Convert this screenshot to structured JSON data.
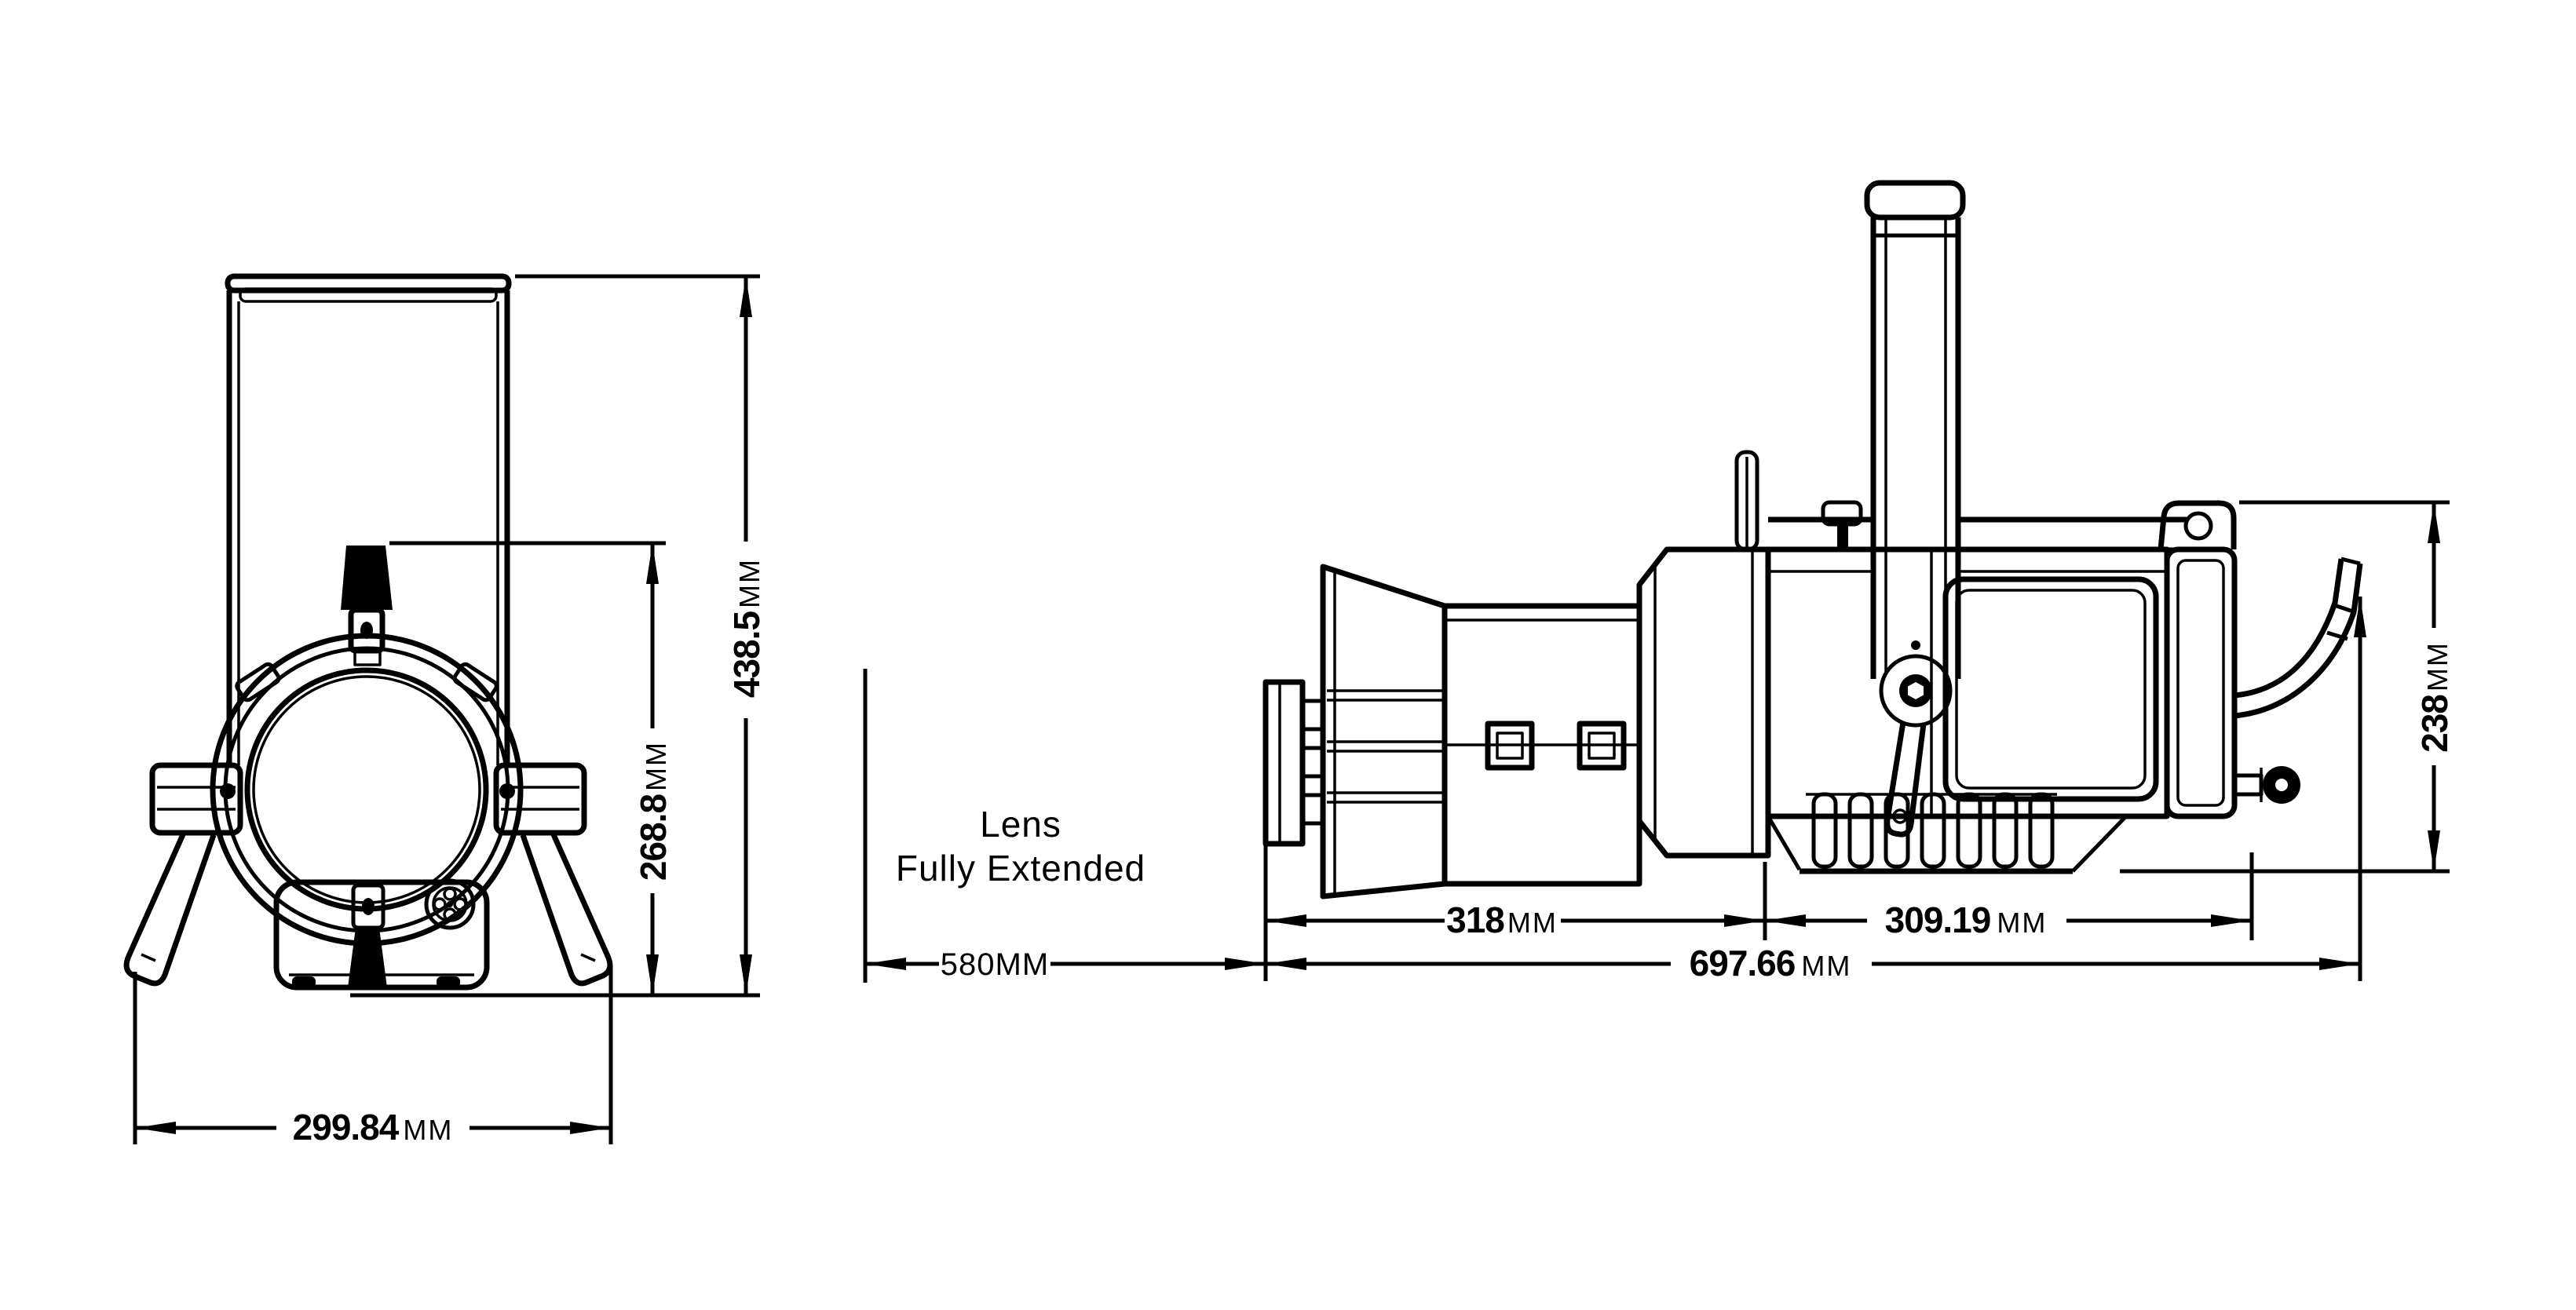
{
  "drawing": {
    "ink": "#000000",
    "background": "#ffffff",
    "front_view": {
      "label": "front-view",
      "dims": {
        "overall_height": {
          "value": "438.5",
          "unit": "MM"
        },
        "knob_height": {
          "value": "268.8",
          "unit": "MM"
        },
        "overall_width": {
          "value": "299.84",
          "unit": "MM"
        }
      }
    },
    "side_view": {
      "label": "side-view",
      "note": {
        "line1": "Lens",
        "line2": "Fully Extended"
      },
      "dims": {
        "lens_extension": {
          "value": "580",
          "unit": "MM"
        },
        "front_section": {
          "value": "318",
          "unit": "MM"
        },
        "rear_section": {
          "value": "309.19",
          "unit": "MM"
        },
        "overall_length": {
          "value": "697.66",
          "unit": "MM"
        },
        "body_height": {
          "value": "238",
          "unit": "MM"
        }
      }
    }
  }
}
